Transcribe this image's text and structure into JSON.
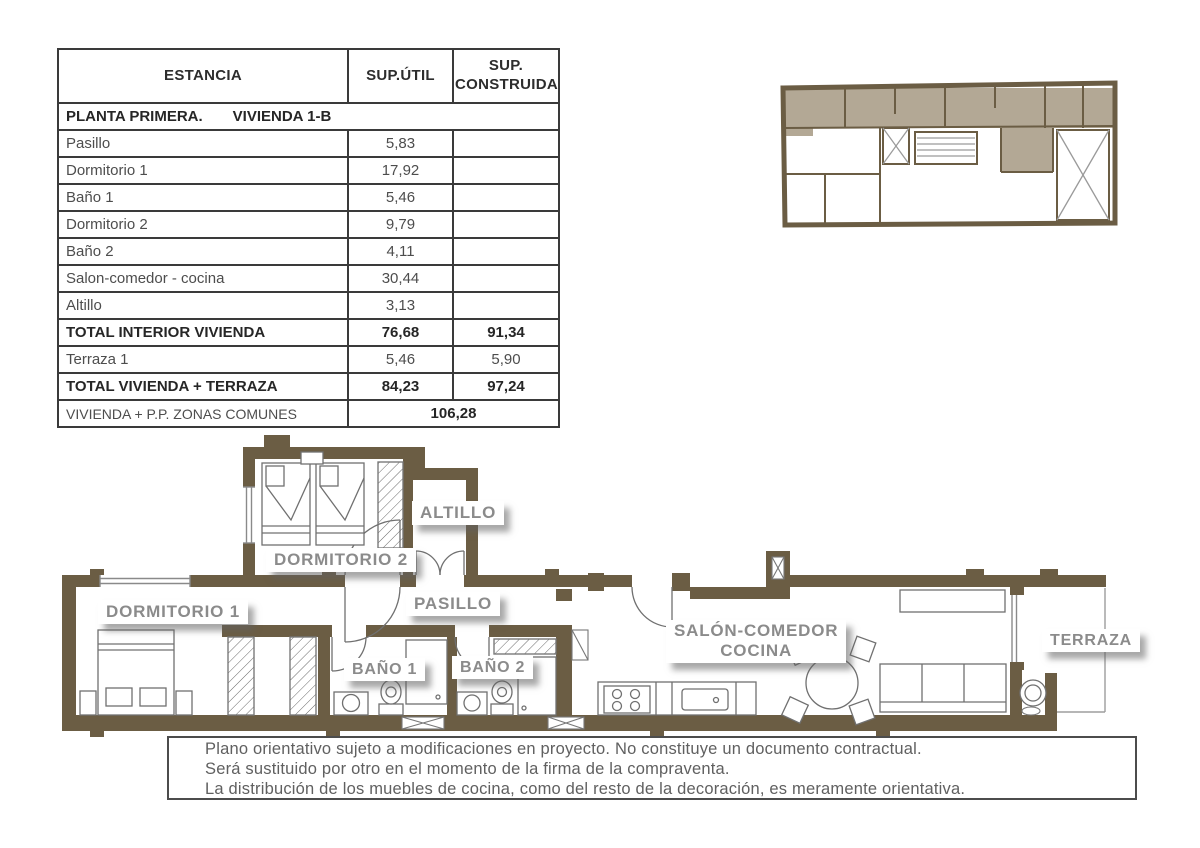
{
  "table": {
    "col_headers": [
      "ESTANCIA",
      "SUP.ÚTIL",
      "SUP. CONSTRUIDA"
    ],
    "section_row": {
      "left": "PLANTA PRIMERA.",
      "right": "VIVIENDA 1-B"
    },
    "rows": [
      {
        "name": "Pasillo",
        "util": "5,83",
        "construida": ""
      },
      {
        "name": "Dormitorio 1",
        "util": "17,92",
        "construida": ""
      },
      {
        "name": "Baño 1",
        "util": "5,46",
        "construida": ""
      },
      {
        "name": "Dormitorio 2",
        "util": "9,79",
        "construida": ""
      },
      {
        "name": "Baño 2",
        "util": "4,11",
        "construida": ""
      },
      {
        "name": "Salon-comedor - cocina",
        "util": "30,44",
        "construida": ""
      },
      {
        "name": "Altillo",
        "util": "3,13",
        "construida": ""
      },
      {
        "name": "TOTAL INTERIOR VIVIENDA",
        "util": "76,68",
        "construida": "91,34"
      },
      {
        "name": "Terraza 1",
        "util": "5,46",
        "construida": "5,90"
      },
      {
        "name": "TOTAL VIVIENDA + TERRAZA",
        "util": "84,23",
        "construida": "97,24"
      },
      {
        "name": "VIVIENDA + P.P. ZONAS COMUNES",
        "merged": "106,28"
      }
    ]
  },
  "plan_labels": {
    "dormitorio1": "DORMITORIO 1",
    "dormitorio2": "DORMITORIO 2",
    "altillo": "ALTILLO",
    "pasillo": "PASILLO",
    "bano1": "BAÑO 1",
    "bano2": "BAÑO 2",
    "salon_line1": "SALÓN-COMEDOR",
    "salon_line2": "COCINA",
    "terraza": "TERRAZA"
  },
  "disclaimer": {
    "line1": "Plano orientativo sujeto a modificaciones en proyecto. No constituye un documento contractual.",
    "line2": "Será sustituido por otro en el momento de la firma de la compraventa.",
    "line3": "La distribución de los muebles de cocina, como del resto de la decoración, es meramente orientativa."
  },
  "plan_furniture_icons": [
    "single-bed",
    "double-bed",
    "wardrobe",
    "sink",
    "toilet",
    "shower",
    "kitchen-counter",
    "stove",
    "kitchen-sink",
    "dining-table",
    "chair",
    "sofa",
    "sideboard",
    "washing-machine"
  ],
  "colors": {
    "wall": "#6b5d44",
    "key_highlight": "#b3a895",
    "label_text": "#8b8b8b",
    "furniture_stroke": "#707070"
  }
}
